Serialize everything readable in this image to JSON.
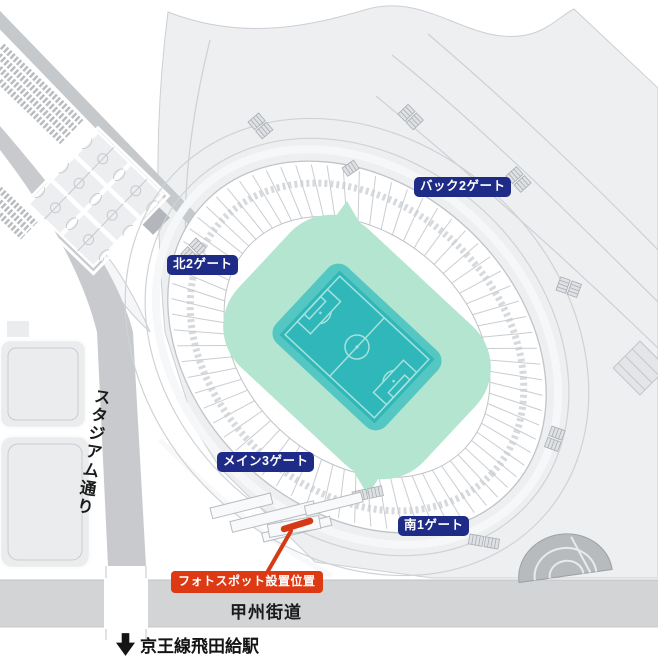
{
  "map": {
    "gates": [
      {
        "id": "north-gate",
        "label": "北2ゲート"
      },
      {
        "id": "back-gate",
        "label": "バック2ゲート"
      },
      {
        "id": "main-gate",
        "label": "メイン3ゲート"
      },
      {
        "id": "south-gate",
        "label": "南1ゲート"
      }
    ],
    "photo_spot": {
      "label": "フォトスポット設置位置"
    },
    "roads": {
      "stadium_street": "スタジアム通り",
      "koshu_kaido": "甲州街道"
    },
    "station": {
      "label": "京王線飛田給駅",
      "icon": "down-arrow-icon"
    },
    "colors": {
      "gate_badge": "#1e2b87",
      "photo_spot_badge": "#dd3a14",
      "photo_spot_marker": "#d63a15",
      "pitch": "#2fb7b9",
      "pitch_surround": "#55c7c3",
      "concourse": "#b4e5d1",
      "plaza": "#edeff1",
      "road": "#c8cacd",
      "main_road_band": "#d2d4d6"
    }
  }
}
